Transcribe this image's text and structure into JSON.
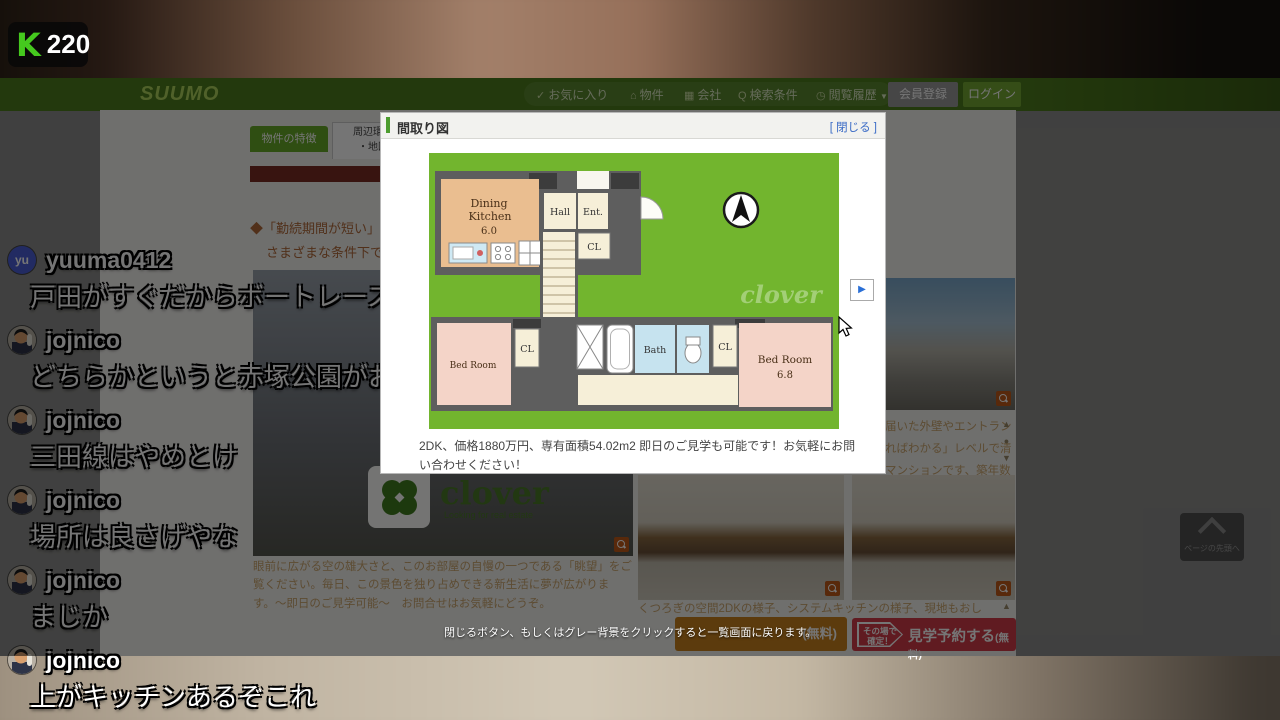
{
  "stream": {
    "badge": {
      "logo": "K",
      "count": "220"
    },
    "chat": {
      "messages": [
        {
          "user": "yuuma0412",
          "text": "戸田がすぐだからボートレースできるよ",
          "avatar_initials": "yu"
        },
        {
          "user": "jojnico",
          "text": "どちらかというと赤塚公園がおさんぽの場所"
        },
        {
          "user": "jojnico",
          "text": "三田線はやめとけ"
        },
        {
          "user": "jojnico",
          "text": "場所は良さげやな"
        },
        {
          "user": "jojnico",
          "text": "まじか"
        },
        {
          "user": "jojnico",
          "text": "上がキッチンあるぞこれ"
        }
      ]
    }
  },
  "site_header": {
    "logo": "SUUMO",
    "nav": {
      "favorites": "お気に入り",
      "property": "物件",
      "company": "会社",
      "criteria": "検索条件",
      "history": "閲覧履歴"
    },
    "icons": {
      "favorites": "✓",
      "property": "⌂",
      "company": "▦",
      "history": "◷",
      "caret": "▼"
    },
    "register": "会員登録",
    "login": "ログイン"
  },
  "page": {
    "tabs": {
      "features": "物件の特徴",
      "map_line1": "周辺環境",
      "map_line2": "・地図"
    },
    "bullets": {
      "b1": "◆「勤続期間が短い」「",
      "b1b": "さまざまな条件下での",
      "b2": "◆「即！見学！」&「車"
    },
    "clover": {
      "word": "clover",
      "tagline": "Looking for real estate"
    },
    "view_caption": "眼前に広がる空の雄大さと、このお部屋の自慢の一つである「眺望」をご覧ください。毎日、この景色を独り占めできる新生活に夢が広がります。〜即日のご見学可能〜　お問合せはお気軽にどうぞ。",
    "kitchen_caption": "くつろぎの空間2DKの様子、システムキッチンの様子、現地もおし",
    "right_text": {
      "l1": "届いた外壁やエントラン",
      "l2": "ればわかる」レベルで清",
      "l3": "マンションです、築年数"
    },
    "arrows": {
      "up": "▲",
      "dot": "●",
      "down": "▼"
    },
    "back_to_top": "ページの先頭へ",
    "cta_orange_fragment": "(無料)",
    "cta_red": {
      "badge_line1": "その場で",
      "badge_line2": "確定！",
      "label": "見学予約する",
      "suffix": "(無料)"
    }
  },
  "modal": {
    "title": "間取り図",
    "close": "[ 閉じる ]",
    "next_arrow": "▶",
    "caption": "2DK、価格1880万円、専有面積54.02m2 即日のご見学も可能です！お気軽にお問い合わせください！",
    "overlay_tip": "閉じるボタン、もしくはグレー背景をクリックすると一覧画面に戻ります。",
    "floorplan": {
      "dining": "Dining",
      "kitchen": "Kitchen",
      "dk_size": "6.0",
      "hall": "Hall",
      "ent": "Ent.",
      "cl": "CL",
      "bath": "Bath",
      "bed_left": "Bed Room",
      "bed_right": "Bed  Room",
      "bed_right_size": "6.8",
      "watermark": "clover"
    }
  },
  "colors": {
    "accent_green": "#4e7d1e",
    "plan_green": "#72b52e",
    "cta_red": "#d23c48",
    "cta_orange": "#c8821e"
  }
}
